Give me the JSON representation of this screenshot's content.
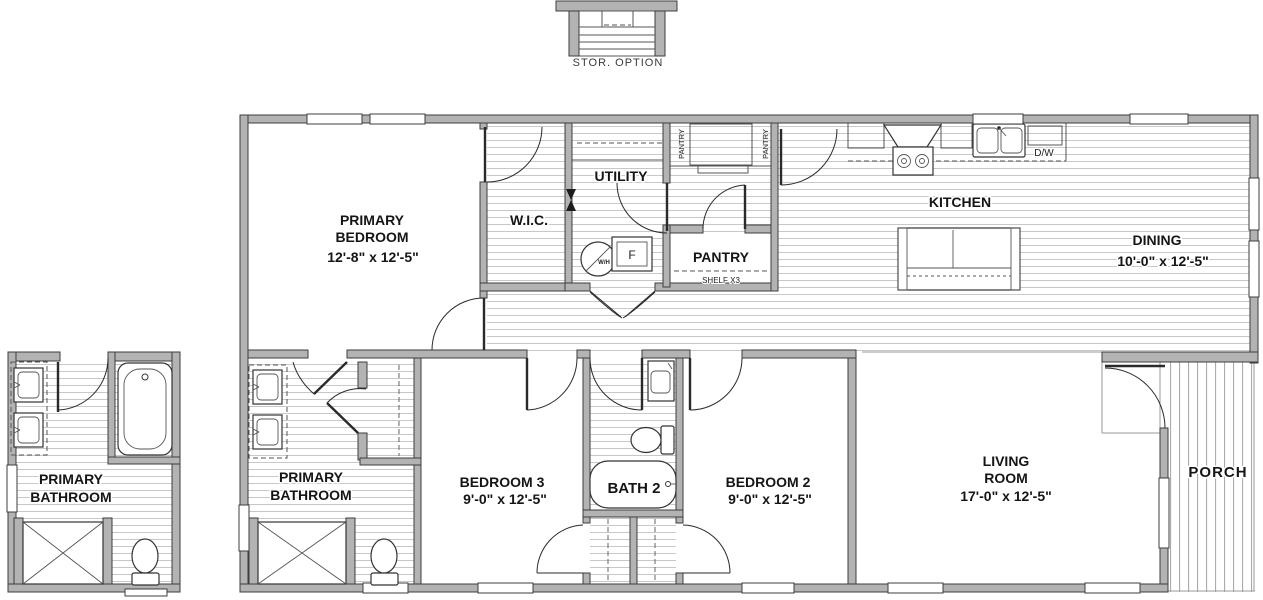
{
  "colors": {
    "wall_fill": "#b3b3b3",
    "wall_stroke": "#3e3e3e",
    "floor_line": "#c8c8c8",
    "porch_line": "#ababab",
    "text": "#151515"
  },
  "storage_option": {
    "label": "STOR.  OPTION"
  },
  "rooms": {
    "primary_bedroom": {
      "line1": "PRIMARY",
      "line2": "BEDROOM",
      "dims": "12'-8\" x  12'-5\""
    },
    "wic": {
      "label": "W.I.C."
    },
    "utility": {
      "label": "UTILITY"
    },
    "pantry_room": {
      "label": "PANTRY",
      "shelf_note": "SHELF X3"
    },
    "kitchen": {
      "label": "KITCHEN"
    },
    "dining": {
      "label": "DINING",
      "dims": "10'-0\" x  12'-5\""
    },
    "primary_bathroom": {
      "line1": "PRIMARY",
      "line2": "BATHROOM"
    },
    "primary_bathroom_option": {
      "line1": "PRIMARY",
      "line2": "BATHROOM"
    },
    "bedroom3": {
      "label": "BEDROOM 3",
      "dims": "9'-0\" x  12'-5\""
    },
    "bath2": {
      "label": "BATH 2"
    },
    "bedroom2": {
      "label": "BEDROOM 2",
      "dims": "9'-0\" x  12'-5\""
    },
    "living_room": {
      "line1": "LIVING",
      "line2": "ROOM",
      "dims": "17'-0\" x  12'-5\""
    },
    "porch": {
      "label": "PORCH"
    }
  },
  "fixtures": {
    "pantry_cabinet_left": "PANTRY",
    "pantry_cabinet_right": "PANTRY",
    "dishwasher": "D/W",
    "freezer": "F",
    "water_heater": "W/H"
  }
}
